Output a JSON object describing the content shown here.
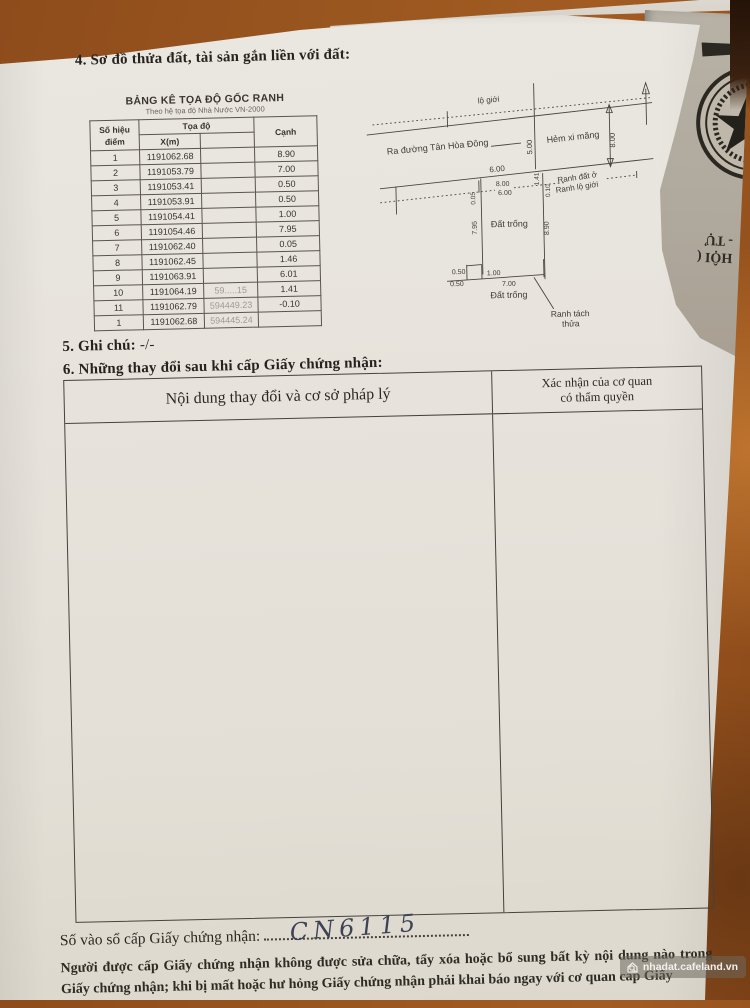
{
  "page": {
    "section4_title": "4. Sơ đồ thửa đất, tài sản gắn liền với đất:",
    "section5_label": "5. Ghi chú:",
    "section5_value": "-/-",
    "section6_title": "6. Những thay đổi sau khi cấp Giấy chứng nhận:",
    "changes_table": {
      "col1_header": "Nội dung thay đổi và cơ sở pháp lý",
      "col2_header_line1": "Xác nhận của cơ quan",
      "col2_header_line2": "có thẩm quyền"
    },
    "serial_label": "Số vào sổ cấp Giấy chứng nhận:",
    "serial_value": "CN6115",
    "footer_line1": "Người được cấp Giấy chứng nhận không được sửa chữa, tẩy xóa hoặc bổ sung bất kỳ nội dung nào trong",
    "footer_line2": "Giấy chứng nhận; khi bị mất hoặc hư hỏng Giấy chứng nhận phải khai báo ngay với cơ quan cấp Giấy"
  },
  "coord_table": {
    "title": "BẢNG KÊ TỌA ĐỘ GỐC RANH",
    "subtitle": "Theo hệ tọa độ Nhà Nước VN-2000",
    "headers": {
      "point": "Số hiệu điểm",
      "coords": "Tọa độ",
      "x": "X(m)",
      "y": "",
      "edge": "Cạnh"
    },
    "rows": [
      {
        "point": "1",
        "x": "1191062.68",
        "y": "",
        "edge": "8.90"
      },
      {
        "point": "2",
        "x": "1191053.79",
        "y": "",
        "edge": "7.00"
      },
      {
        "point": "3",
        "x": "1191053.41",
        "y": "",
        "edge": "0.50"
      },
      {
        "point": "4",
        "x": "1191053.91",
        "y": "",
        "edge": "0.50"
      },
      {
        "point": "5",
        "x": "1191054.41",
        "y": "",
        "edge": "1.00"
      },
      {
        "point": "6",
        "x": "1191054.46",
        "y": "",
        "edge": "7.95"
      },
      {
        "point": "7",
        "x": "1191062.40",
        "y": "",
        "edge": "0.05"
      },
      {
        "point": "8",
        "x": "1191062.45",
        "y": "",
        "edge": "1.46"
      },
      {
        "point": "9",
        "x": "1191063.91",
        "y": "",
        "edge": "6.01"
      },
      {
        "point": "10",
        "x": "1191064.19",
        "y": "59.....15",
        "edge": "1.41"
      },
      {
        "point": "11",
        "x": "1191062.79",
        "y": "594449.23",
        "edge": "-0.10"
      },
      {
        "point": "1",
        "x": "1191062.68",
        "y": "594445.24",
        "edge": ""
      }
    ]
  },
  "diagram": {
    "label_lo_gioi": "lộ giới",
    "label_street": "Ra đường Tân Hòa Đông",
    "label_hem": "Hẻm xi măng",
    "dim_500": "5.00",
    "dim_800_right": "8.00",
    "dim_600": "6.00",
    "dim_800_mid": "8.00",
    "dim_600_mid": "6.00",
    "label_ranh_dat_o": "Ranh đất ở",
    "label_ranh_lo_gioi": "Ranh lộ giới",
    "dim_141": "1.41",
    "dim_010": "0.10",
    "dim_005": "0.05",
    "dim_795": "7.95",
    "dim_890": "8.90",
    "label_dat_trong_upper": "Đất trống",
    "dims_bottom": [
      "0.50",
      "0.50",
      "1.00",
      "7.00"
    ],
    "label_dat_trong_lower": "Đất trống",
    "label_ranh_tach": "Ranh tách",
    "label_thua": "thửa"
  },
  "underlying_doc": {
    "line1": "HỘI (",
    "line2": "- TỰ"
  },
  "watermark": {
    "text": "nhadat.cafeland.vn"
  }
}
